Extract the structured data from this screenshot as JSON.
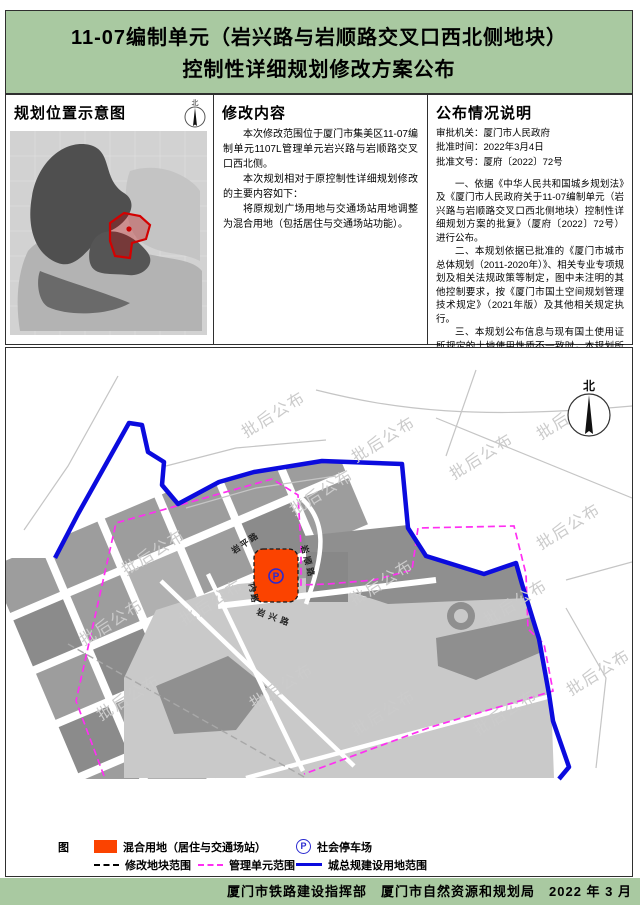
{
  "title": {
    "line1": "11-07编制单元（岩兴路与岩顺路交叉口西北侧地块）",
    "line2": "控制性详细规划修改方案公布"
  },
  "location_panel": {
    "heading": "规划位置示意图",
    "compass_label": "北"
  },
  "content_panel": {
    "heading": "修改内容",
    "paragraphs": [
      "本次修改范围位于厦门市集美区11-07编制单元1107L管理单元岩兴路与岩顺路交叉口西北侧。",
      "本次规划相对于原控制性详细规划修改的主要内容如下：",
      "将原规划广场用地与交通场站用地调整为混合用地（包括居住与交通场站功能）。"
    ]
  },
  "announcement_panel": {
    "heading": "公布情况说明",
    "meta": [
      "审批机关：厦门市人民政府",
      "批准时间：2022年3月4日",
      "批准文号：厦府〔2022〕72号"
    ],
    "paragraphs": [
      "一、依据《中华人民共和国城乡规划法》及《厦门市人民政府关于11-07编制单元（岩兴路与岩顺路交叉口西北侧地块）控制性详细规划方案的批复》（厦府〔2022〕72号）进行公布。",
      "二、本规划依据已批准的《厦门市城市总体规划（2011-2020年）》、相关专业专项规划及相关法规政策等制定，图中未注明的其他控制要求，按《厦门市国土空间规划管理技术规定》（2021年版）及其他相关规定执行。",
      "三、本规划公布信息与现有国土使用证所规定的土地使用性质不一致时，本规划所示的土地用途应视为政府对该地区发展的引导。",
      "四、需进一步了解本区控规详细信息，可到厦门市自然资源和规划局查询相关控规详细图则。",
      "五、本版公布的规划内容以厦门市自然资源和规划局存档备查的相关控制性详细规划最新版本为准。",
      "六、根据国家有关保密规定，涉及保密内容不予公布。",
      "七、本规划最终解释权归厦门市自然资源和规划局。"
    ]
  },
  "map": {
    "watermark": "批后公布",
    "compass_label": "北",
    "parking_symbol": "P",
    "roads": {
      "yanping": "岩平路",
      "yanshun": "岩顺路",
      "nei": "内路",
      "yanxing": "岩兴路"
    },
    "colors": {
      "parcel_orange": "#fb4300",
      "urban_boundary_blue": "#0b0bde",
      "unit_boundary_magenta": "#ff2ef2",
      "watermark_gray": "#cbcbcb",
      "banner_green": "#a9c9a1"
    }
  },
  "legend": {
    "title": "图　例",
    "items": [
      {
        "label": "混合用地（居住与交通场站）"
      },
      {
        "label": "社会停车场"
      },
      {
        "label": "修改地块范围"
      },
      {
        "label": "管理单元范围"
      },
      {
        "label": "城总规建设用地范围"
      }
    ]
  },
  "footer": {
    "text": "厦门市铁路建设指挥部　厦门市自然资源和规划局　2022 年 3 月"
  }
}
